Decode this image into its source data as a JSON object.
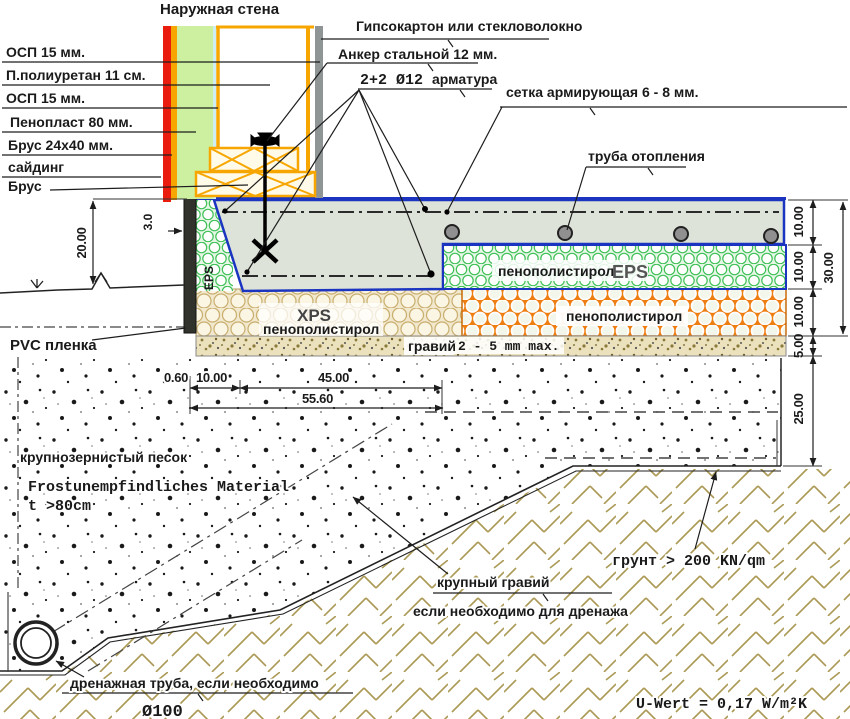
{
  "labels": {
    "title": "Наружная стена",
    "osb1": "ОСП 15 мм.",
    "polyurethane": "П.полиуретан 11 см.",
    "osb2": "ОСП 15 мм.",
    "penoplast": "Пенопласт 80 мм.",
    "batten": "Брус 24х40 мм.",
    "siding": "сайдинг",
    "beam": "Брус",
    "gypsum": "Гипсокартон или стекловолокно",
    "anchor": "Анкер стальной 12 мм.",
    "rebar_count": "2+2 Ø12",
    "rebar_word": "арматура",
    "mesh": "сетка армирующая 6 - 8 мм.",
    "heat_pipe": "труба отопления",
    "pvc": "PVC пленка",
    "eps_side": "EPS",
    "eps_block": "пенополистирол",
    "eps_block_type": "EPS",
    "xps_type": "XPS",
    "xps_block": "пенополистирол",
    "pps_orange": "пенополистирол",
    "gravel": "гравий",
    "gravel_grade": "2 - 5 mm max.",
    "sand": "крупнозернистый песок",
    "frost_line1": "Frostunempfindliches Material",
    "frost_line2": "t >80cm",
    "drain": "дренажная труба, если необходимо",
    "drain_dia": "Ø100",
    "coarse_gravel": "крупный гравий",
    "coarse_gravel_note": "если необходимо для дренажа",
    "soil_bearing": "грунт > 200 KN/qm",
    "u_value": "U-Wert = 0,17 W/m²K"
  },
  "dims": {
    "wall_height": "20.00",
    "edge_thk": "3.0",
    "w1": "0.60",
    "w2": "10.00",
    "w3": "45.00",
    "w_total": "55.60",
    "slab": "10.00",
    "eps": "10.00",
    "xps": "10.00",
    "gravel": "5.00",
    "sand": "25.00",
    "insul_total": "30.00"
  },
  "colors": {
    "outline_blue": "#1c35c0",
    "siding_red": "#ea1c0d",
    "timber_orange": "#f7a600",
    "wall_foam_green": "#cdf0a0",
    "pale_blue": "#cdeef2",
    "gray_board": "#8f9494",
    "dark_strip": "#32322c",
    "concrete": "#dde3d8",
    "eps_green": "#3fc057",
    "xps_tan": "#c9ae6e",
    "pps_orange": "#ee7d12",
    "soil_tan": "#ab9a55",
    "gravel_bg": "#ece1bd"
  }
}
